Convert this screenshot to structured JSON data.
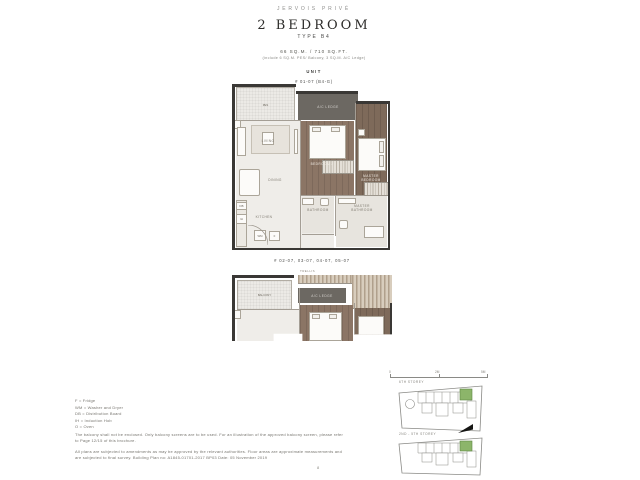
{
  "header": {
    "brand": "JERVOIS PRIVÉ",
    "title": "2 BEDROOM",
    "subtitle": "TYPE B4",
    "area": "66 SQ.M. / 710 SQ.FT.",
    "area_note": "(include 6 SQ.M. PES/ Balcony, 3 SQ.M. A/C Ledge)",
    "unit_label": "UNIT",
    "unit_number": "# 01-07 (B4-G)"
  },
  "plan_upper": {
    "rooms": {
      "pes": "PES",
      "ac_ledge": "A/C LEDGE",
      "living": "LIVING",
      "dining": "DINING",
      "kitchen": "KITCHEN",
      "bedroom2": "BEDROOM 2",
      "bathroom": "BATHROOM",
      "master_bedroom": "MASTER BEDROOM",
      "master_bathroom": "MASTER BATHROOM"
    },
    "markers": {
      "db": "DB",
      "ih": "IH",
      "wm": "WM",
      "f": "F"
    }
  },
  "plan_lower": {
    "caption": "# 02-07, 03-07, 04-07, 05-07",
    "rooms": {
      "balcony": "BALCONY",
      "ac_ledge": "A/C LEDGE",
      "trellis": "TRELLIS"
    }
  },
  "legend": {
    "items": [
      "F = Fridge",
      "WM = Washer and Dryer",
      "DB = Distribution Board",
      "IH = Induction Hob",
      "O = Oven"
    ]
  },
  "disclaimer": {
    "para1": "The balcony shall not be enclosed. Only balcony screens are to be used. For an illustration of the approved balcony screen, please refer to Page 12/15 of this brochure.",
    "para2": "All plans are subjected to amendments as may be approved by the relevant authorities. Floor areas are approximate measurements and are subjected to final survey. Building Plan no: A1845-01701-2017 BP03 Date: 05 November 2019"
  },
  "scale_bar": {
    "labels": [
      "0",
      "2M",
      "5M"
    ]
  },
  "key_plans": [
    {
      "label": "6TH STOREY"
    },
    {
      "label": "2ND - 5TH STOREY"
    }
  ],
  "page_number": "8",
  "colors": {
    "wall": "#3a3835",
    "wood_floor": "#8b7565",
    "wood_floor_dark": "#7e6a5a",
    "marble_floor": "#efede9",
    "ac_ledge": "#6c6862",
    "highlight_unit_green": "#8cb56a",
    "title_text": "#2d2c2a",
    "muted_text": "#77756f"
  }
}
